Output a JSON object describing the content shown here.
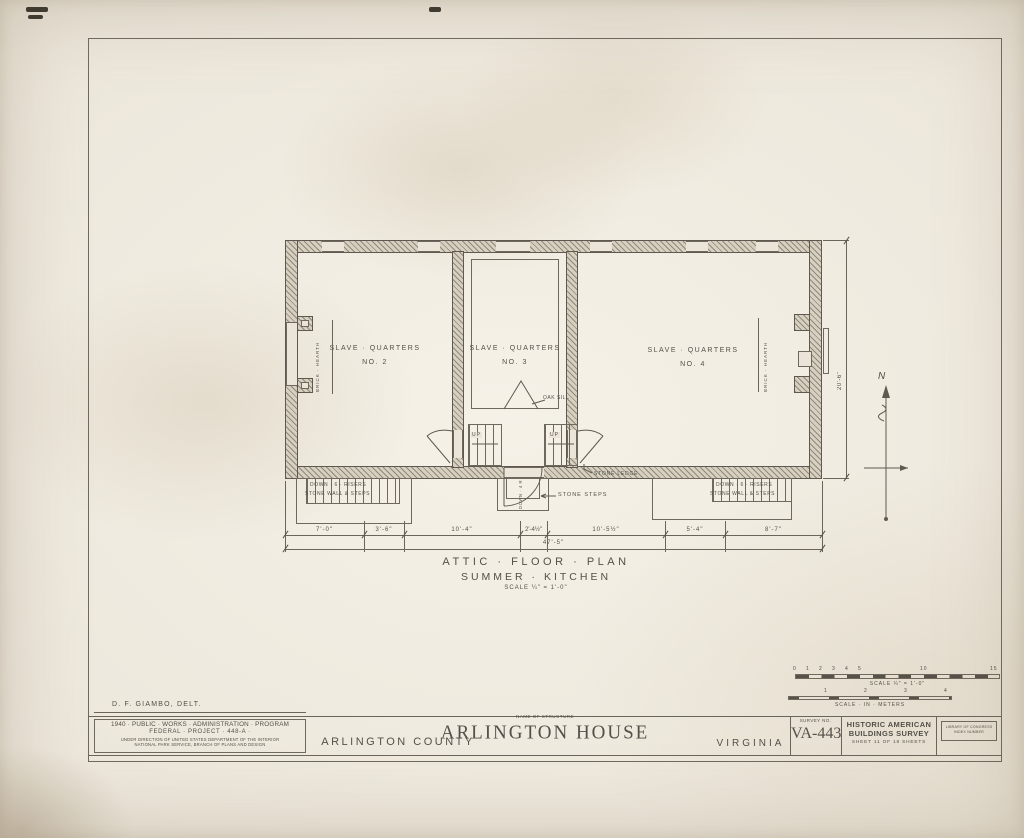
{
  "sheet": {
    "delineator": "D. F. GIAMBO, DELT."
  },
  "plan": {
    "rooms": [
      {
        "line1": "SLAVE · QUARTERS",
        "line2": "NO. 2"
      },
      {
        "line1": "SLAVE · QUARTERS",
        "line2": "NO. 3"
      },
      {
        "line1": "SLAVE · QUARTERS",
        "line2": "NO. 4"
      }
    ],
    "annotations": {
      "brick_hearth_left": "BRICK · HEARTH",
      "brick_hearth_right": "BRICK · HEARTH",
      "oak_sill": "OAK SILL",
      "up_left": "UP",
      "up_right": "UP",
      "down_4_risers": "DOWN · 4 R",
      "stone_ledge": "STONE LEDGE",
      "stone_steps": "STONE STEPS",
      "left_stair_line1": "DOWN · 6 · RISERS",
      "left_stair_line2": "STONE WALL & STEPS",
      "right_stair_line1": "DOWN · 6 · RISERS",
      "right_stair_line2": "STONE WALL & STEPS"
    },
    "dimensions": {
      "segments": [
        "7'-0\"",
        "3'-6\"",
        "10'-4\"",
        "2'-4½\"",
        "10'-5½\"",
        "5'-4\"",
        "8'-7\""
      ],
      "overall": "47'-5\"",
      "right_vertical": "20'-6\""
    }
  },
  "figure_title": {
    "line1": "ATTIC · FLOOR · PLAN",
    "line2": "SUMMER · KITCHEN",
    "scale": "SCALE ¼\" = 1'-0\""
  },
  "north_arrow": {
    "label": "N"
  },
  "scale_bars": {
    "feet": {
      "ticks": [
        "0",
        "1",
        "2",
        "3",
        "4",
        "5",
        "10",
        "15"
      ],
      "label": "SCALE ¼\" = 1'-0\""
    },
    "meters": {
      "ticks": [
        "1",
        "2",
        "3",
        "4"
      ],
      "label": "SCALE · IN · METERS"
    }
  },
  "title_block": {
    "program_line1": "1940 · PUBLIC · WORKS · ADMINISTRATION · PROGRAM",
    "program_line2": "FEDERAL · PROJECT · 448-A ·",
    "program_line3": "UNDER DIRECTION OF UNITED STATES DEPARTMENT OF THE INTERIOR",
    "program_line4": "NATIONAL PARK SERVICE, BRANCH OF PLANS AND DESIGN",
    "county": "ARLINGTON COUNTY",
    "structure_label": "NAME OF STRUCTURE",
    "structure_name": "ARLINGTON HOUSE",
    "state": "VIRGINIA",
    "survey_label": "SURVEY NO.",
    "survey_number": "VA-443",
    "habs_line1": "HISTORIC AMERICAN",
    "habs_line2": "BUILDINGS SURVEY",
    "sheet_line": "SHEET 11 OF 18 SHEETS",
    "loc_line1": "LIBRARY OF CONGRESS",
    "loc_line2": "INDEX NUMBER"
  },
  "colors": {
    "paper": "#e9e3d6",
    "ink": "#53504a",
    "wall_fill": "#d7d0c0"
  }
}
